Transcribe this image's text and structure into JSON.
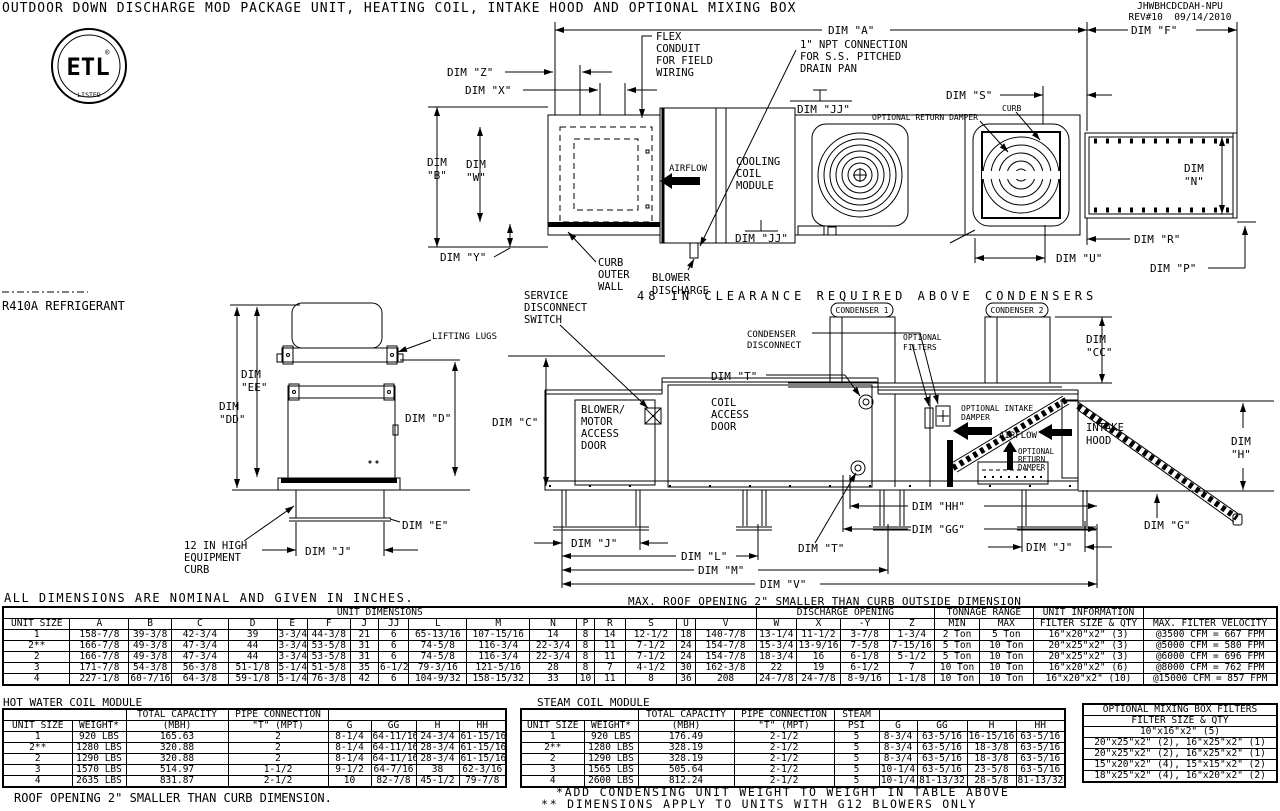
{
  "header": {
    "title": "OUTDOOR DOWN DISCHARGE MOD PACKAGE UNIT, HEATING COIL, INTAKE HOOD AND OPTIONAL MIXING BOX",
    "doc_no": "JHWBHCDCDAH-NPU",
    "revision": "REV#10  09/14/2010",
    "logo_main": "ETL",
    "logo_sub": "LISTED",
    "logo_reg": "®"
  },
  "notes": {
    "refrigerant": "R410A REFRIGERANT",
    "clearance": "48 IN CLEARANCE REQUIRED ABOVE CONDENSERS",
    "nominal": "ALL DIMENSIONS ARE NOMINAL AND GIVEN IN INCHES.",
    "roof_main": "MAX. ROOF OPENING 2\" SMALLER THAN CURB OUTSIDE DIMENSION",
    "roof_hw": "ROOF OPENING 2\" SMALLER THAN CURB DIMENSION.",
    "footnote1": "*ADD CONDENSING UNIT WEIGHT TO WEIGHT IN TABLE ABOVE",
    "footnote2": "** DIMENSIONS APPLY TO UNITS WITH G12 BLOWERS ONLY"
  },
  "plan": {
    "dim_a": "DIM \"A\"",
    "dim_f": "DIM \"F\"",
    "dim_z": "DIM \"Z\"",
    "dim_x": "DIM \"X\"",
    "dim_b": "DIM\n\"B\"",
    "dim_w": "DIM\n\"W\"",
    "dim_y": "DIM \"Y\"",
    "dim_jj_top": "DIM \"JJ\"",
    "dim_jj_mid": "DIM \"JJ\"",
    "dim_s": "DIM \"S\"",
    "dim_n": "DIM\n\"N\"",
    "dim_r": "DIM \"R\"",
    "dim_u": "DIM \"U\"",
    "dim_p": "DIM \"P\"",
    "flex_conduit": "FLEX\nCONDUIT\nFOR FIELD\nWIRING",
    "npt": "1\" NPT CONNECTION\nFOR S.S. PITCHED\nDRAIN PAN",
    "airflow": "AIRFLOW",
    "cooling_coil": "COOLING\nCOIL\nMODULE",
    "optional_return_damper": "OPTIONAL RETURN DAMPER",
    "curb": "CURB",
    "curb_outer_wall": "CURB\nOUTER\nWALL",
    "blower_discharge": "BLOWER\nDISCHARGE"
  },
  "front": {
    "dim_ee": "DIM\n\"EE\"",
    "dim_dd": "DIM\n\"DD\"",
    "dim_d": "DIM \"D\"",
    "dim_e": "DIM \"E\"",
    "dim_j": "DIM \"J\"",
    "lifting_lugs": "LIFTING LUGS",
    "equipment_curb": "12 IN HIGH\nEQUIPMENT\nCURB"
  },
  "side": {
    "service_disconnect": "SERVICE\nDISCONNECT\nSWITCH",
    "dim_c": "DIM \"C\"",
    "blower_door": "BLOWER/\nMOTOR\nACCESS\nDOOR",
    "coil_door": "COIL\nACCESS\nDOOR",
    "dim_t_top": "DIM \"T\"",
    "condenser1": "CONDENSER 1",
    "condenser2": "CONDENSER 2",
    "condenser_disconnect": "CONDENSER\nDISCONNECT",
    "optional_filters": "OPTIONAL\nFILTERS",
    "dim_cc": "DIM\n\"CC\"",
    "optional_intake_damper": "OPTIONAL INTAKE\nDAMPER",
    "airflow": "AIRFLOW",
    "optional_return_damper": "OPTIONAL\nRETURN\nDAMPER",
    "intake_hood": "INTAKE\nHOOD",
    "dim_h": "DIM\n\"H\"",
    "dim_g": "DIM \"G\"",
    "dim_hh": "DIM \"HH\"",
    "dim_gg": "DIM \"GG\"",
    "dim_j_left": "DIM \"J\"",
    "dim_j_right": "DIM \"J\"",
    "dim_l": "DIM \"L\"",
    "dim_m": "DIM \"M\"",
    "dim_v": "DIM \"V\"",
    "dim_t_bottom": "DIM \"T\""
  },
  "unit_table": {
    "header_rows": [
      [
        {
          "t": "UNIT DIMENSIONS",
          "c": 17
        },
        {
          "t": "DISCHARGE OPENING",
          "c": 4
        },
        {
          "t": "TONNAGE RANGE",
          "c": 2
        },
        {
          "t": "UNIT INFORMATION",
          "c": 1
        },
        {
          "t": "",
          "c": 1
        }
      ],
      [
        "UNIT SIZE",
        "A",
        "B",
        "C",
        "D",
        "E",
        "F",
        "J",
        "JJ",
        "L",
        "M",
        "N",
        "P",
        "R",
        "S",
        "U",
        "V",
        "W",
        "X",
        "-Y",
        "Z",
        "MIN",
        "MAX",
        "FILTER SIZE & QTY",
        "MAX. FILTER VELOCITY"
      ]
    ],
    "rows": [
      [
        "1",
        "158-7/8",
        "39-3/8",
        "42-3/4",
        "39",
        "3-3/4",
        "44-3/8",
        "21",
        "6",
        "65-13/16",
        "107-15/16",
        "14",
        "8",
        "14",
        "12-1/2",
        "18",
        "140-7/8",
        "13-1/4",
        "11-1/2",
        "3-7/8",
        "1-3/4",
        "2 Ton",
        "5 Ton",
        "16\"x20\"x2\" (3)",
        "@3500 CFM = 667 FPM"
      ],
      [
        "2**",
        "166-7/8",
        "49-3/8",
        "47-3/4",
        "44",
        "3-3/4",
        "53-5/8",
        "31",
        "6",
        "74-5/8",
        "116-3/4",
        "22-3/4",
        "8",
        "11",
        "7-1/2",
        "24",
        "154-7/8",
        "15-3/4",
        "13-9/16",
        "7-5/8",
        "7-15/16",
        "5 Ton",
        "10 Ton",
        "20\"x25\"x2\" (3)",
        "@5000 CFM = 580 FPM"
      ],
      [
        "2",
        "166-7/8",
        "49-3/8",
        "47-3/4",
        "44",
        "3-3/4",
        "53-5/8",
        "31",
        "6",
        "74-5/8",
        "116-3/4",
        "22-3/4",
        "8",
        "11",
        "7-1/2",
        "24",
        "154-7/8",
        "18-3/4",
        "16",
        "6-1/8",
        "5-1/2",
        "5 Ton",
        "10 Ton",
        "20\"x25\"x2\" (3)",
        "@6000 CFM = 696 FPM"
      ],
      [
        "3",
        "171-7/8",
        "54-3/8",
        "56-3/8",
        "51-1/8",
        "5-1/4",
        "51-5/8",
        "35",
        "6-1/2",
        "79-3/16",
        "121-5/16",
        "28",
        "8",
        "7",
        "4-1/2",
        "30",
        "162-3/8",
        "22",
        "19",
        "6-1/2",
        "7",
        "10 Ton",
        "10 Ton",
        "16\"x20\"x2\" (6)",
        "@8000 CFM = 762 FPM"
      ],
      [
        "4",
        "227-1/8",
        "60-7/16",
        "64-3/8",
        "59-1/8",
        "5-1/4",
        "76-3/8",
        "42",
        "6",
        "104-9/32",
        "158-15/32",
        "33",
        "10",
        "11",
        "8",
        "36",
        "208",
        "24-7/8",
        "24-7/8",
        "8-9/16",
        "1-1/8",
        "10 Ton",
        "10 Ton",
        "16\"x20\"x2\" (10)",
        "@15000 CFM = 857 FPM"
      ]
    ]
  },
  "hot_water": {
    "title": "HOT WATER COIL MODULE",
    "header_rows": [
      [
        {
          "t": "",
          "c": 2
        },
        {
          "t": "TOTAL CAPACITY"
        },
        {
          "t": "PIPE CONNECTION"
        },
        {
          "t": "",
          "c": 4
        }
      ],
      [
        "UNIT SIZE",
        "WEIGHT*",
        "(MBH)",
        "\"T\" (MPT)",
        "G",
        "GG",
        "H",
        "HH"
      ]
    ],
    "rows": [
      [
        "1",
        "920 LBS",
        "165.63",
        "2",
        "8-1/4",
        "64-11/16",
        "24-3/4",
        "61-15/16"
      ],
      [
        "2**",
        "1280 LBS",
        "320.88",
        "2",
        "8-1/4",
        "64-11/16",
        "28-3/4",
        "61-15/16"
      ],
      [
        "2",
        "1290 LBS",
        "320.88",
        "2",
        "8-1/4",
        "64-11/16",
        "28-3/4",
        "61-15/16"
      ],
      [
        "3",
        "1570 LBS",
        "514.97",
        "1-1/2",
        "9-1/2",
        "64-7/16",
        "38",
        "62-3/16"
      ],
      [
        "4",
        "2635 LBS",
        "831.87",
        "2-1/2",
        "10",
        "82-7/8",
        "45-1/2",
        "79-7/8"
      ]
    ]
  },
  "steam": {
    "title": "STEAM COIL MODULE",
    "header_rows": [
      [
        {
          "t": "",
          "c": 2
        },
        {
          "t": "TOTAL CAPACITY"
        },
        {
          "t": "PIPE CONNECTION"
        },
        {
          "t": "STEAM"
        },
        {
          "t": "",
          "c": 4
        }
      ],
      [
        "UNIT SIZE",
        "WEIGHT*",
        "(MBH)",
        "\"T\" (MPT)",
        "PSI",
        "G",
        "GG",
        "H",
        "HH"
      ]
    ],
    "rows": [
      [
        "1",
        "920 LBS",
        "176.49",
        "2-1/2",
        "5",
        "8-3/4",
        "63-5/16",
        "16-15/16",
        "63-5/16"
      ],
      [
        "2**",
        "1280 LBS",
        "328.19",
        "2-1/2",
        "5",
        "8-3/4",
        "63-5/16",
        "18-3/8",
        "63-5/16"
      ],
      [
        "2",
        "1290 LBS",
        "328.19",
        "2-1/2",
        "5",
        "8-3/4",
        "63-5/16",
        "18-3/8",
        "63-5/16"
      ],
      [
        "3",
        "1565 LBS",
        "505.64",
        "2-1/2",
        "5",
        "10-1/4",
        "63-5/16",
        "23-5/8",
        "63-5/16"
      ],
      [
        "4",
        "2600 LBS",
        "812.24",
        "2-1/2",
        "5",
        "10-1/4",
        "81-13/32",
        "28-5/8",
        "81-13/32"
      ]
    ]
  },
  "mixing": {
    "header_rows": [
      [
        {
          "t": "OPTIONAL MIXING BOX FILTERS"
        }
      ],
      [
        {
          "t": "FILTER SIZE & QTY"
        }
      ]
    ],
    "rows": [
      [
        "10\"x16\"x2\" (5)"
      ],
      [
        "20\"x25\"x2\" (2), 16\"x25\"x2\" (1)"
      ],
      [
        "20\"x25\"x2\" (2), 16\"x25\"x2\" (1)"
      ],
      [
        "15\"x20\"x2\" (4), 15\"x15\"x2\" (2)"
      ],
      [
        "18\"x25\"x2\" (4), 16\"x20\"x2\" (2)"
      ]
    ]
  }
}
